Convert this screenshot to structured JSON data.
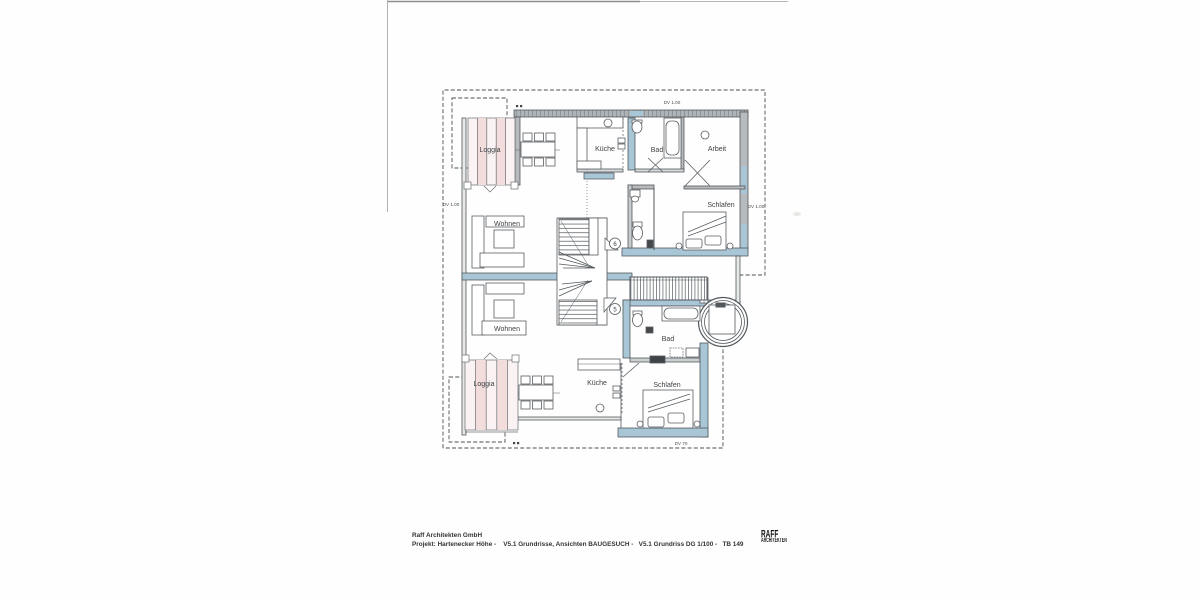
{
  "plan": {
    "rooms": {
      "loggia_upper": "Loggia",
      "kueche_upper": "Küche",
      "bad_upper": "Bad",
      "arbeit": "Arbeit",
      "schlafen_upper": "Schlafen",
      "wohnen_upper": "Wohnen",
      "wohnen_lower": "Wohnen",
      "loggia_lower": "Loggia",
      "kueche_lower": "Küche",
      "bad_lower": "Bad",
      "schlafen_lower": "Schlafen"
    },
    "dimension_labels": {
      "top": "DV 1.00",
      "left": "DV 1.00",
      "right": "DV 1.00",
      "bottom": "DV 70"
    },
    "door_tags": {
      "upper": "6",
      "lower": "5"
    },
    "colors": {
      "wall_gray": "#aeb3b6",
      "wall_blue": "#a9c6d6",
      "loggia_pink": "#f6e7e7",
      "line": "#53585c"
    }
  },
  "titleblock": {
    "company": "Raff Architekten GmbH",
    "project_line": "Projekt: Hartenecker Höhe -    V5.1 Grundrisse, Ansichten BAUGESUCH -   V5.1 Grundriss DG 1/100 -   TB 149",
    "logo": {
      "top": "RAFF",
      "bottom": "ARCHITEKTEN"
    }
  }
}
